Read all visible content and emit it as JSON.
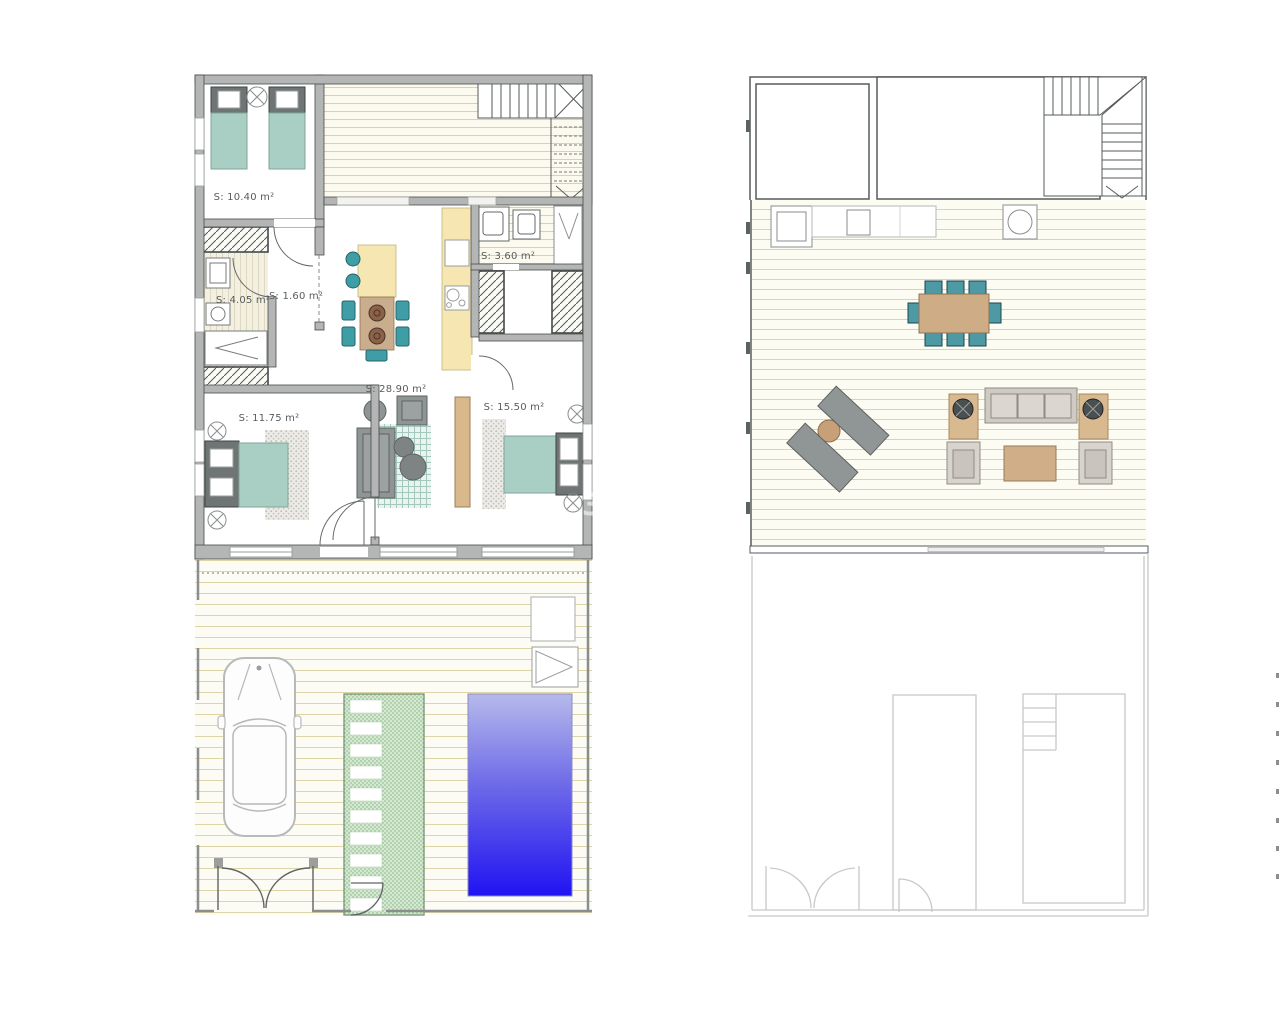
{
  "plans": {
    "ground_floor": {
      "title": "ground-floor-plan",
      "rooms": [
        {
          "key": "bedroom_top",
          "area": "S: 10.40 m²"
        },
        {
          "key": "bathroom",
          "area": "S: 4.05 m²"
        },
        {
          "key": "hall",
          "area": "S: 1.60 m²"
        },
        {
          "key": "utility",
          "area": "S: 3.60 m²"
        },
        {
          "key": "living_kitchen",
          "area": "S: 28.90 m²"
        },
        {
          "key": "bedroom_left",
          "area": "S: 11.75 m²"
        },
        {
          "key": "bedroom_right",
          "area": "S: 15.50 m²"
        }
      ],
      "watermark_fragment": "3"
    },
    "upper_floor": {
      "title": "upper-floor-plan",
      "rooms": []
    }
  },
  "colors": {
    "wall_gray": "#b4b6b5",
    "ink": "#4a4e4e",
    "bed_teal": "#a9cec3",
    "chair_teal": "#3f9da5",
    "counter_yellow": "#f6e7b2",
    "wood_tan": "#c9ad8d",
    "sofa_gray": "#8f9494",
    "deck_line": "#d9d0a2",
    "path_green": "#d5e9d2",
    "pool_top": "#b6baeb",
    "pool_bottom": "#2013f2"
  }
}
